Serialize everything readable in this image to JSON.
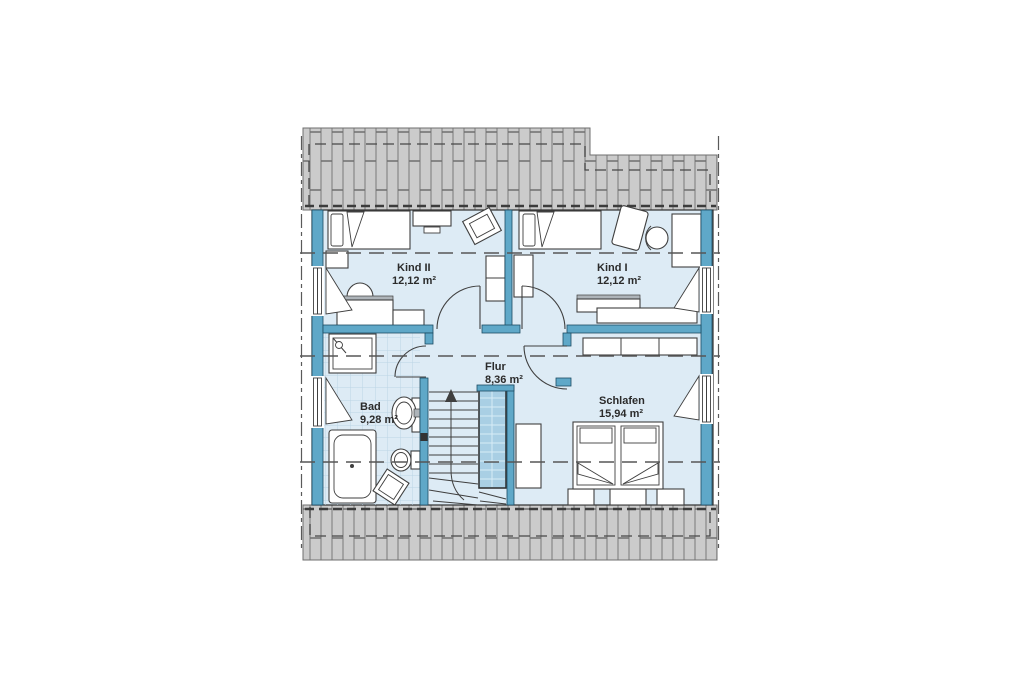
{
  "plan": {
    "rooms": [
      {
        "id": "kind2",
        "name": "Kind II",
        "area": "12,12 m²"
      },
      {
        "id": "kind1",
        "name": "Kind I",
        "area": "12,12 m²"
      },
      {
        "id": "flur",
        "name": "Flur",
        "area": "8,36 m²"
      },
      {
        "id": "bad",
        "name": "Bad",
        "area": "9,28 m²"
      },
      {
        "id": "schlafen",
        "name": "Schlafen",
        "area": "15,94 m²"
      }
    ],
    "colors": {
      "wall": "#5fa8c8",
      "floor": "#ddebf5",
      "roof": "#cbcbcb",
      "stairwell": "#a9cfe4",
      "tile_line": "#bcd4e5",
      "text": "#2b2b2b"
    }
  }
}
